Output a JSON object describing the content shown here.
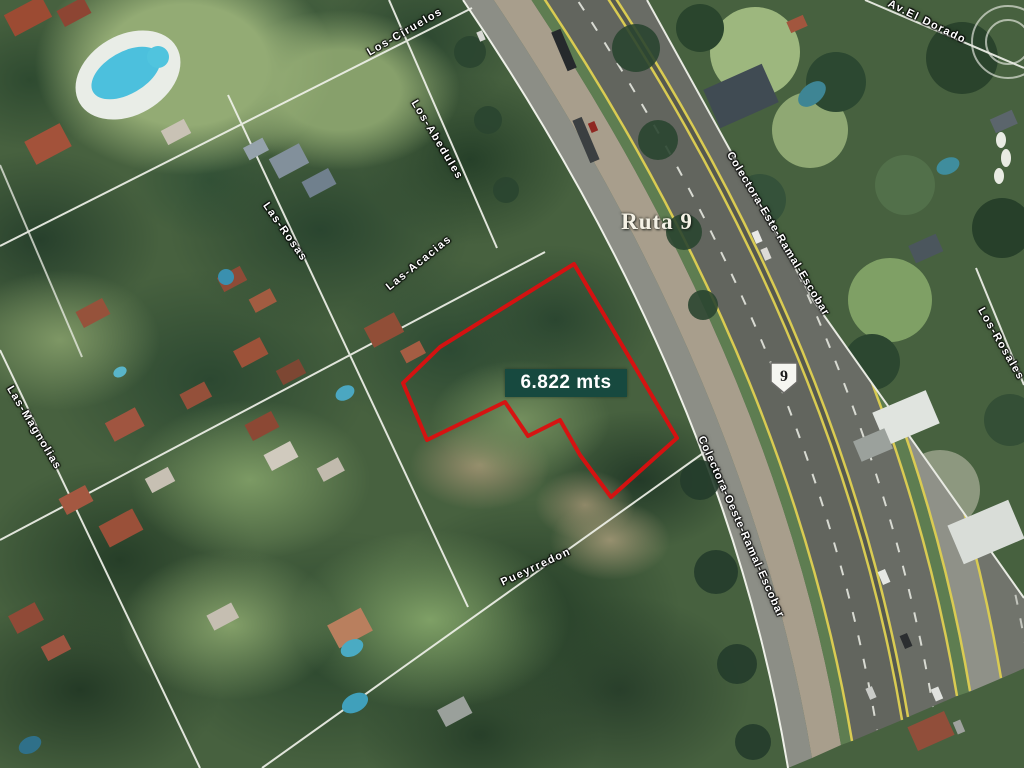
{
  "map": {
    "parcel": {
      "area_label": "6.822 mts"
    },
    "highway": {
      "name": "Ruta 9",
      "route_shield": "9"
    },
    "streets": [
      {
        "label": "Los-Ciruelos"
      },
      {
        "label": "Los-Abedules"
      },
      {
        "label": "Las-Rosas"
      },
      {
        "label": "Las-Acacias"
      },
      {
        "label": "Las-Magnolias"
      },
      {
        "label": "Pueyrredon"
      },
      {
        "label": "Colectora-Este-Ramal-Escobar"
      },
      {
        "label": "Colectora-Oeste-Ramal-Escobar"
      },
      {
        "label": "Av.El Dorado"
      },
      {
        "label": "Los-Rosales"
      }
    ],
    "colors": {
      "parcel_outline": "#db1010",
      "area_box_bg": "#17493f",
      "street_label": "#ffffff",
      "highway_label": "#f5f2e6",
      "road_yellow_line": "#d9cb52",
      "pool_water": "#4cc0dd"
    }
  }
}
